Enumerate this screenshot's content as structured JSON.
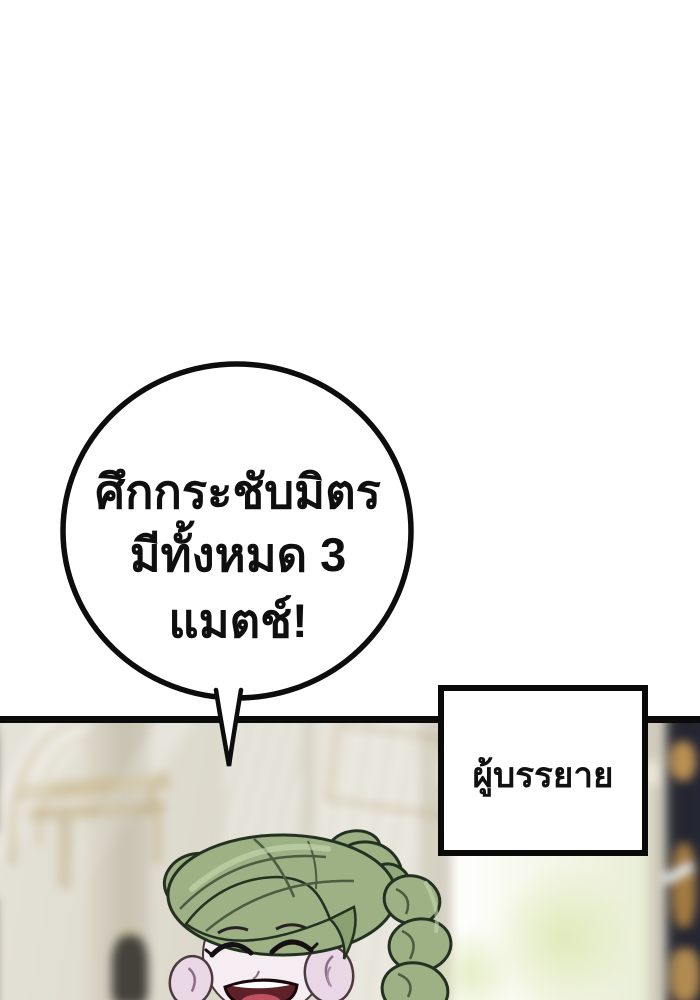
{
  "page": {
    "background": "#ffffff",
    "type": "webtoon-panel"
  },
  "speech_bubble": {
    "line1": "ศึกกระชับมิตร",
    "line2": "มีทั้งหมด 3 แมตช์!",
    "fill": "#ffffff",
    "border_color": "#0d0d0d"
  },
  "narrator_box": {
    "label": "ผู้บรรยาย",
    "fill": "#ffffff",
    "border_color": "#0a0a0a"
  },
  "panel": {
    "border_color": "#0b0b0b",
    "scene": "blurred marble hall with light rays, bright doorway and dark ornate column",
    "colors": {
      "wall_cream": "#d7d3c6",
      "wall_light": "#e5e2d8",
      "gold_trim": "#ae9259",
      "doorway": "#f7f9ec",
      "flare_green": "#e2ebc6",
      "dark_column": "#262834",
      "column_gold": "#ab8149",
      "light_ray": "rgba(255,255,255,0.55)"
    },
    "character": {
      "description": "smiling woman with closed eyes and green braided hair",
      "hair_color": "#9db184",
      "hair_shadow": "#4a5c42",
      "hair_outline": "#233122",
      "hair_highlight": "#c4d6ae",
      "skin_color": "#f5edf1",
      "ear_shadow": "#d9c3d9",
      "mouth_inner": "#5e2029",
      "tongue": "#c05260"
    }
  }
}
